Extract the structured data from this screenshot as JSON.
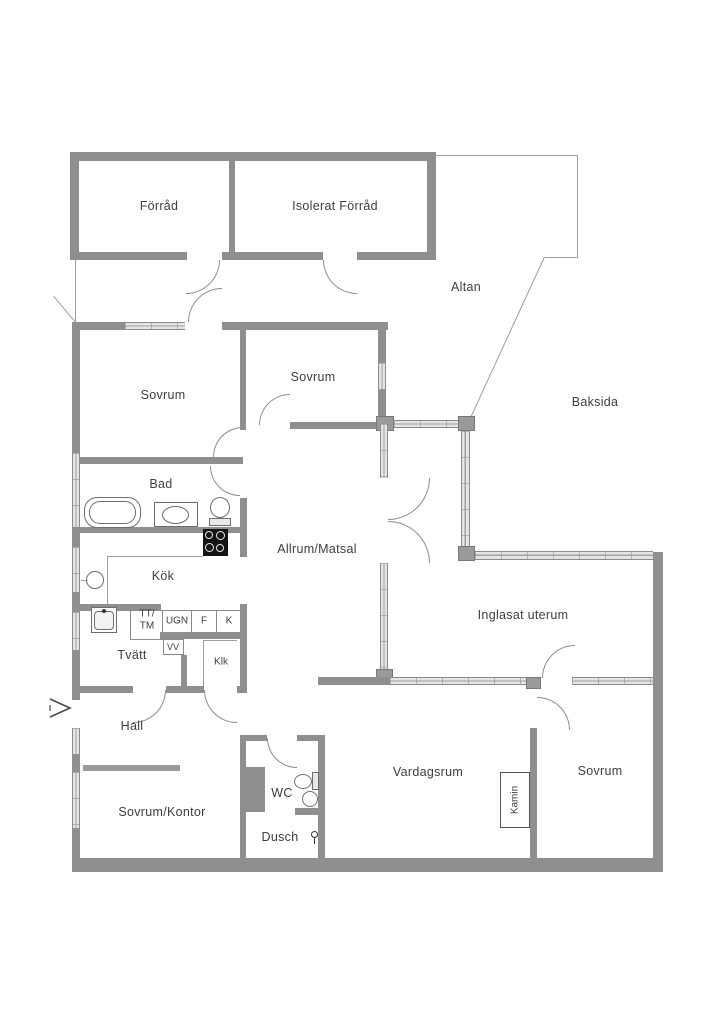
{
  "plan": {
    "title": "floor-plan",
    "colors": {
      "wall": "#8f8f8f",
      "window_fill": "#e4e4e4",
      "outline": "#9e9e9e",
      "text": "#3e3e3e",
      "background": "#ffffff",
      "stove": "#141414"
    },
    "rooms": {
      "forrad": "Förråd",
      "isolerat_forrad": "Isolerat Förråd",
      "altan": "Altan",
      "baksida": "Baksida",
      "sovrum_nw": "Sovrum",
      "sovrum_n": "Sovrum",
      "bad": "Bad",
      "allrum_matsal": "Allrum/Matsal",
      "kok": "Kök",
      "inglasat_uterum": "Inglasat uterum",
      "tvatt": "Tvätt",
      "klk": "Klk",
      "hall": "Hall",
      "sovrum_kontor": "Sovrum/Kontor",
      "wc": "WC",
      "dusch": "Dusch",
      "vardagsrum": "Vardagsrum",
      "sovrum_se": "Sovrum",
      "kamin": "Kamin"
    },
    "appliances": {
      "tt_line1": "TT/",
      "tt_line2": "TM",
      "ugn": "UGN",
      "f": "F",
      "k": "K",
      "vv": "VV"
    },
    "symbols": {
      "entrance_arrow": "entry direction arrow pointing east into Hall"
    }
  }
}
